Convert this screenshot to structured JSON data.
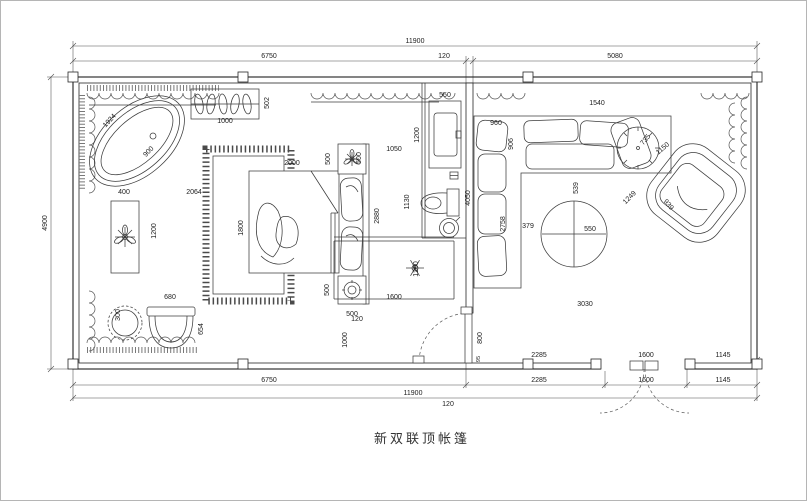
{
  "title": {
    "text": "新双联顶帐篷"
  },
  "colors": {
    "line": "#1f1f1f",
    "dim": "#4c4c4c",
    "background": "#ffffff",
    "frame": "#b5b5b5"
  },
  "labels": {
    "dim_11900": "11900",
    "dim_6750": "6750",
    "dim_120": "120",
    "dim_5080": "5080",
    "dim_4900": "4900",
    "dim_2285": "2285",
    "dim_1600": "1600",
    "dim_1145": "1145",
    "tub_1924": "1924",
    "tub_900": "900",
    "rack_1000": "1000",
    "rack_502": "502",
    "console_400": "400",
    "console_2064": "2064",
    "console_1200": "1200",
    "bed_2000": "2000",
    "bed_1800": "1800",
    "bed_500": "500",
    "bed_2880": "2880",
    "bath_1050": "1050",
    "vanity_550": "550",
    "vanity_1200": "1200",
    "toilet_1130": "1130",
    "wall_4050": "4050",
    "shower_1200": "1200",
    "shower_1600": "1600",
    "shower_120": "120",
    "shower_1000": "1000",
    "door_800": "800",
    "door_95": "95",
    "sofa_960": "960",
    "sofa_906": "906",
    "sofa_1540": "1540",
    "sofa_2758": "2758",
    "sofa_539": "539",
    "table_379": "379",
    "table_550": "550",
    "room_3030": "3030",
    "side_table_735": "735",
    "chair_1150": "1150",
    "chair_939": "939",
    "chair_1249": "1249",
    "stool_300": "300",
    "tubchair_680": "680",
    "tubchair_654": "654"
  }
}
